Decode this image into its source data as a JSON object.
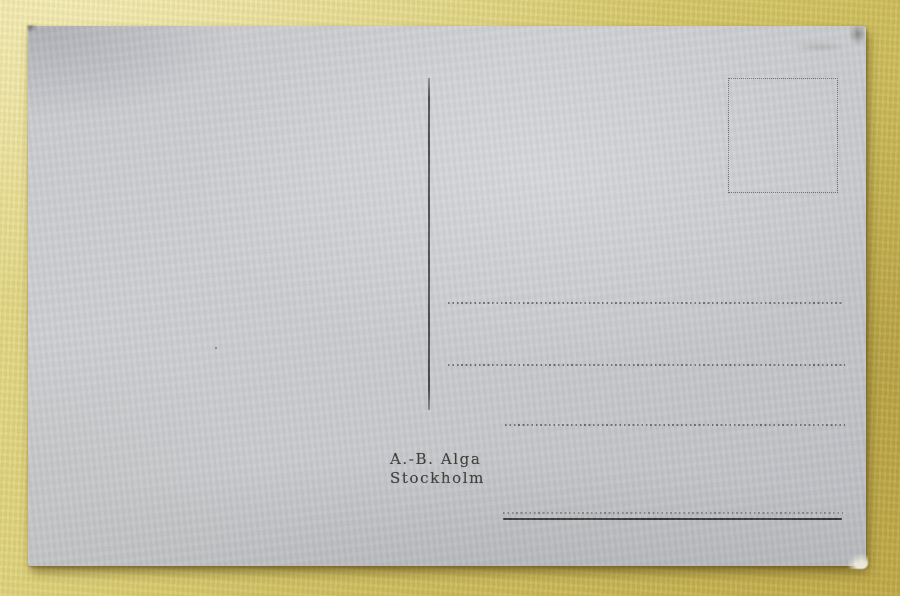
{
  "postcard": {
    "publisher_line1": "A.-B. Alga",
    "publisher_line2": "Stockholm"
  },
  "colors": {
    "table_background": "#d7ca6c",
    "card_paper": "#c8c9cd",
    "print_ink": "#3b3a36",
    "rule_gray": "#6e6e68"
  }
}
